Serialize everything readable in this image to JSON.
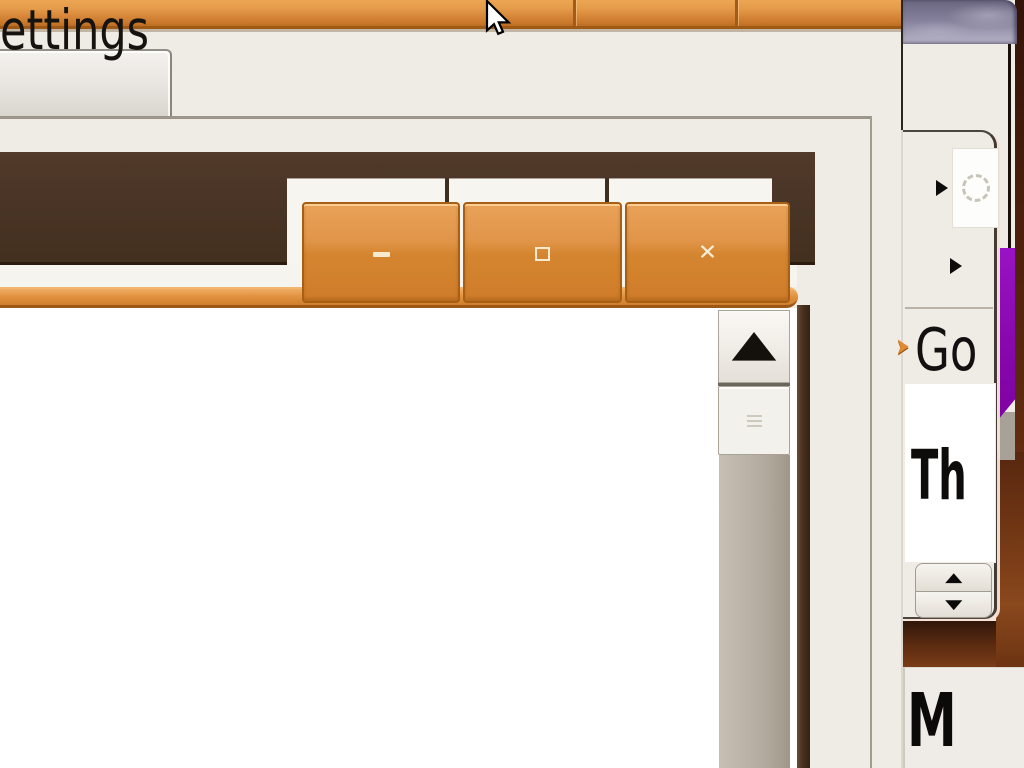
{
  "settings_dialog": {
    "tab": {
      "label": "ettings"
    }
  },
  "magnified_window": {
    "controls": {
      "minimize_label": "minimize",
      "maximize_label": "maximize",
      "close_glyph": "✕"
    },
    "scrollbar": {
      "up_arrow_glyph": "▲"
    }
  },
  "right_panel": {
    "go_text": "Go",
    "th_text": "Th",
    "m_text": "M",
    "submenu_arrow_glyph": "▶",
    "caret_glyph": "➤",
    "spinner_hint": "dotted-circle",
    "spin_up_glyph": "▲",
    "spin_down_glyph": "▼"
  },
  "icons": {
    "cursor": "arrow-pointer",
    "minimize-icon": "minus-bar",
    "maximize-icon": "square-outline",
    "close-icon": "✕",
    "scroll-up-icon": "▲",
    "scrollbar-grip-icon": "≡",
    "submenu-icon": "▶",
    "spinner-icon": "dotted-circle",
    "caret-icon": "➤",
    "spin-up-icon": "▲",
    "spin-down-icon": "▼"
  },
  "colors": {
    "accent_orange": "#d8883a",
    "titlebar_brown": "#4a3526",
    "wallpaper_maroon": "#4c200c",
    "purple_accent": "#8607ab",
    "cloudy_titlebar": "#847f9a",
    "beige_background": "#efece5"
  }
}
